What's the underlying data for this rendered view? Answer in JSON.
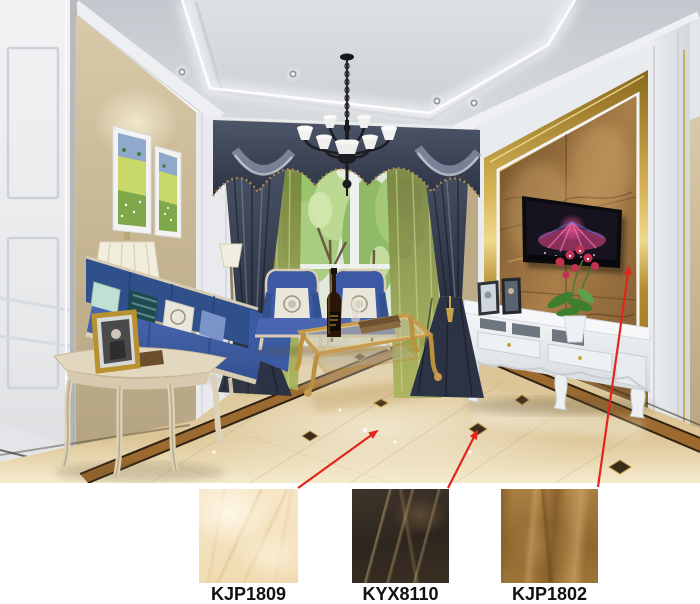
{
  "page": {
    "background": "#ffffff",
    "type": "tile-product-showcase"
  },
  "products": [
    {
      "code": "KJP1809",
      "swatch_style": "cream beige marble tile",
      "base_color": "#f2e0ba"
    },
    {
      "code": "KYX8110",
      "swatch_style": "dark emperador marble tile",
      "base_color": "#352b21"
    },
    {
      "code": "KJP1802",
      "swatch_style": "caramel brown marble tile",
      "base_color": "#9a7035"
    }
  ],
  "annotations": {
    "arrow_color": "#e2251c",
    "arrows": [
      {
        "from": "swatch-kjp1809",
        "points_to": "main floor field tile"
      },
      {
        "from": "swatch-kyx8110",
        "points_to": "dark floor accent diamond"
      },
      {
        "from": "swatch-kjp1802",
        "points_to": "tv feature wall marble"
      }
    ]
  },
  "scene_colors": {
    "ceiling": "#ccd1d6",
    "cove_light": "#ffffff",
    "wallpaper": "#c9b996",
    "floor_base": "#ecd9ae",
    "floor_border": "#9c6a2e",
    "tv_wall_marble": "#8a6234",
    "gold_trim": "#d4b254",
    "sofa_blue": "#3e5ba6",
    "curtain_navy": "#39414f",
    "sheer_green": "#8a9648"
  }
}
